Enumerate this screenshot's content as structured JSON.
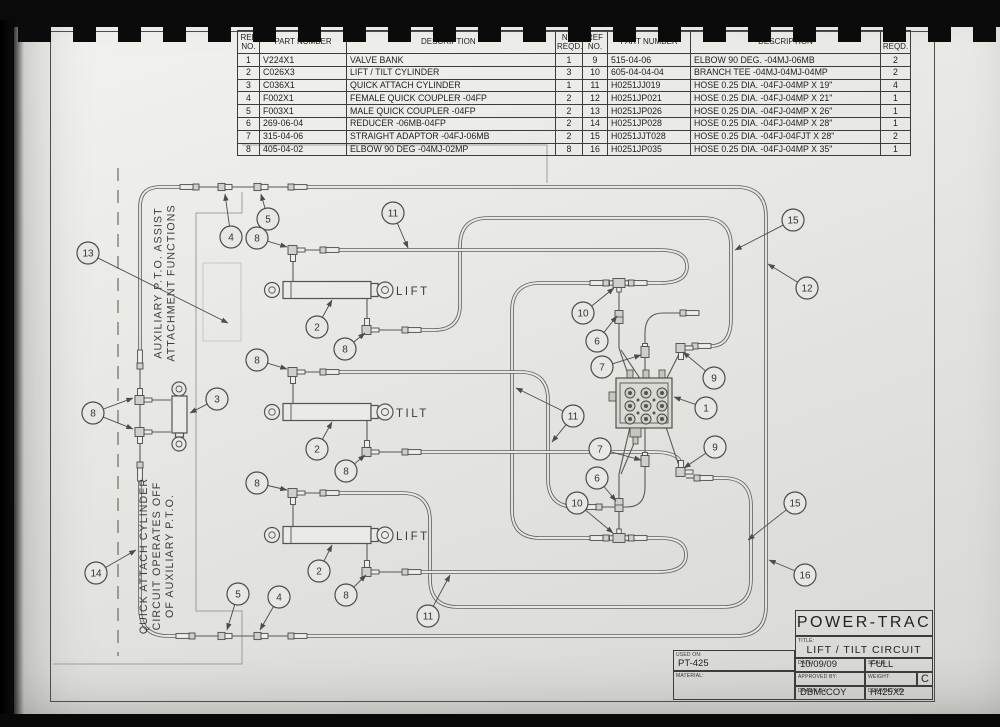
{
  "parts_table": {
    "headers_left": [
      "REF NO.",
      "PART NUMBER",
      "DESCRIPTION *",
      "NO. REQD."
    ],
    "headers_right": [
      "REF NO.",
      "PART NUMBER",
      "DESCRIPTION",
      "NO. REQD."
    ],
    "left_rows": [
      [
        "1",
        "V224X1",
        "VALVE BANK",
        "1"
      ],
      [
        "2",
        "C026X3",
        "LIFT / TILT CYLINDER",
        "3"
      ],
      [
        "3",
        "C036X1",
        "QUICK ATTACH CYLINDER",
        "1"
      ],
      [
        "4",
        "F002X1",
        "FEMALE QUICK COUPLER -04FP",
        "2"
      ],
      [
        "5",
        "F003X1",
        "MALE QUICK COUPLER -04FP",
        "2"
      ],
      [
        "6",
        "269-06-04",
        "REDUCER -06MB-04FP",
        "2"
      ],
      [
        "7",
        "315-04-06",
        "STRAIGHT ADAPTOR -04FJ-06MB",
        "2"
      ],
      [
        "8",
        "405-04-02",
        "ELBOW 90 DEG -04MJ-02MP",
        "8"
      ]
    ],
    "right_rows": [
      [
        "9",
        "515-04-06",
        "ELBOW 90 DEG. -04MJ-06MB",
        "2"
      ],
      [
        "10",
        "605-04-04-04",
        "BRANCH TEE -04MJ-04MJ-04MP",
        "2"
      ],
      [
        "11",
        "H0251JJ019",
        "HOSE 0.25 DIA. -04FJ-04MP X 19\"",
        "4"
      ],
      [
        "12",
        "H0251JP021",
        "HOSE 0.25 DIA. -04FJ-04MP X 21\"",
        "1"
      ],
      [
        "13",
        "H0251JP026",
        "HOSE 0.25 DIA. -04FJ-04MP X 26\"",
        "1"
      ],
      [
        "14",
        "H0251JP028",
        "HOSE 0.25 DIA. -04FJ-04MP X 28\"",
        "1"
      ],
      [
        "15",
        "H0251JJT028",
        "HOSE 0.25 DIA. -04FJ-04FJT X 28\"",
        "2"
      ],
      [
        "16",
        "H0251JP035",
        "HOSE 0.25 DIA. -04FJ-04MP X 35\"",
        "1"
      ]
    ]
  },
  "title_block": {
    "company": "POWER-TRAC",
    "title_label": "TITLE:",
    "title": "LIFT / TILT CIRCUIT",
    "used_on_label": "USED ON:",
    "used_on": "PT-425",
    "material_label": "MATERIAL:",
    "material": "",
    "date_label": "DATE:",
    "date": "10/09/09",
    "scale_label": "SCALE:",
    "scale": "FULL",
    "approved_label": "APPROVED BY:",
    "approved": "",
    "weight_label": "WEIGHT:",
    "weight": "",
    "revision": "C",
    "drawn_label": "DRAWN BY:",
    "drawn_by": "DBMcCOY",
    "drawing_no_label": "DRAWING NO:",
    "drawing_no": "H425X2"
  },
  "diagram": {
    "notes": [
      {
        "lines": [
          "AUXILIARY P.T.O. ASSIST",
          "ATTACHMENT FUNCTIONS"
        ],
        "x": 168,
        "y": 283
      },
      {
        "lines": [
          "QUICK ATTACH CYLINDER",
          "CIRCUIT OPERATES OFF",
          "OF AUXILIARY P.T.O."
        ],
        "x": 160,
        "y": 556
      }
    ],
    "cylinder_labels": [
      {
        "text": "LIFT",
        "x": 396,
        "y": 295
      },
      {
        "text": "TILT",
        "x": 396,
        "y": 417
      },
      {
        "text": "LIFT",
        "x": 396,
        "y": 540
      }
    ],
    "balloons": [
      {
        "n": "13",
        "x": 88,
        "y": 253,
        "to": [
          [
            228,
            323
          ]
        ]
      },
      {
        "n": "8",
        "x": 93,
        "y": 413,
        "to": [
          [
            133,
            398
          ],
          [
            133,
            429
          ]
        ]
      },
      {
        "n": "3",
        "x": 217,
        "y": 399,
        "to": [
          [
            190,
            413
          ]
        ]
      },
      {
        "n": "14",
        "x": 96,
        "y": 573,
        "to": [
          [
            136,
            550
          ]
        ]
      },
      {
        "n": "4",
        "x": 231,
        "y": 237,
        "to": [
          [
            225,
            194
          ]
        ]
      },
      {
        "n": "5",
        "x": 268,
        "y": 219,
        "to": [
          [
            261,
            194
          ]
        ]
      },
      {
        "n": "8",
        "x": 257,
        "y": 238,
        "to": [
          [
            287,
            247
          ]
        ]
      },
      {
        "n": "11",
        "x": 393,
        "y": 213,
        "to": [
          [
            408,
            248
          ]
        ]
      },
      {
        "n": "2",
        "x": 317,
        "y": 327,
        "to": [
          [
            332,
            300
          ]
        ]
      },
      {
        "n": "8",
        "x": 345,
        "y": 349,
        "to": [
          [
            365,
            333
          ]
        ]
      },
      {
        "n": "8",
        "x": 257,
        "y": 360,
        "to": [
          [
            287,
            369
          ]
        ]
      },
      {
        "n": "2",
        "x": 317,
        "y": 449,
        "to": [
          [
            332,
            422
          ]
        ]
      },
      {
        "n": "8",
        "x": 346,
        "y": 471,
        "to": [
          [
            365,
            455
          ]
        ]
      },
      {
        "n": "8",
        "x": 257,
        "y": 483,
        "to": [
          [
            287,
            490
          ]
        ]
      },
      {
        "n": "2",
        "x": 319,
        "y": 571,
        "to": [
          [
            332,
            545
          ]
        ]
      },
      {
        "n": "8",
        "x": 346,
        "y": 595,
        "to": [
          [
            366,
            575
          ]
        ]
      },
      {
        "n": "5",
        "x": 238,
        "y": 594,
        "to": [
          [
            227,
            630
          ]
        ]
      },
      {
        "n": "4",
        "x": 279,
        "y": 597,
        "to": [
          [
            260,
            630
          ]
        ]
      },
      {
        "n": "11",
        "x": 428,
        "y": 616,
        "to": [
          [
            450,
            575
          ]
        ]
      },
      {
        "n": "11",
        "x": 573,
        "y": 416,
        "to": [
          [
            516,
            388
          ],
          [
            552,
            442
          ]
        ]
      },
      {
        "n": "15",
        "x": 793,
        "y": 220,
        "to": [
          [
            735,
            250
          ]
        ]
      },
      {
        "n": "12",
        "x": 807,
        "y": 288,
        "to": [
          [
            768,
            264
          ]
        ]
      },
      {
        "n": "10",
        "x": 583,
        "y": 313,
        "to": [
          [
            614,
            288
          ]
        ]
      },
      {
        "n": "6",
        "x": 597,
        "y": 341,
        "to": [
          [
            617,
            316
          ]
        ]
      },
      {
        "n": "7",
        "x": 602,
        "y": 367,
        "to": [
          [
            641,
            355
          ]
        ]
      },
      {
        "n": "9",
        "x": 714,
        "y": 378,
        "to": [
          [
            683,
            352
          ]
        ]
      },
      {
        "n": "1",
        "x": 706,
        "y": 408,
        "to": [
          [
            674,
            397
          ]
        ]
      },
      {
        "n": "7",
        "x": 600,
        "y": 449,
        "to": [
          [
            641,
            460
          ]
        ]
      },
      {
        "n": "9",
        "x": 715,
        "y": 447,
        "to": [
          [
            684,
            468
          ]
        ]
      },
      {
        "n": "6",
        "x": 597,
        "y": 478,
        "to": [
          [
            616,
            501
          ]
        ]
      },
      {
        "n": "10",
        "x": 577,
        "y": 503,
        "to": [
          [
            613,
            533
          ]
        ]
      },
      {
        "n": "15",
        "x": 795,
        "y": 503,
        "to": [
          [
            748,
            540
          ]
        ]
      },
      {
        "n": "16",
        "x": 805,
        "y": 575,
        "to": [
          [
            769,
            560
          ]
        ]
      }
    ]
  }
}
